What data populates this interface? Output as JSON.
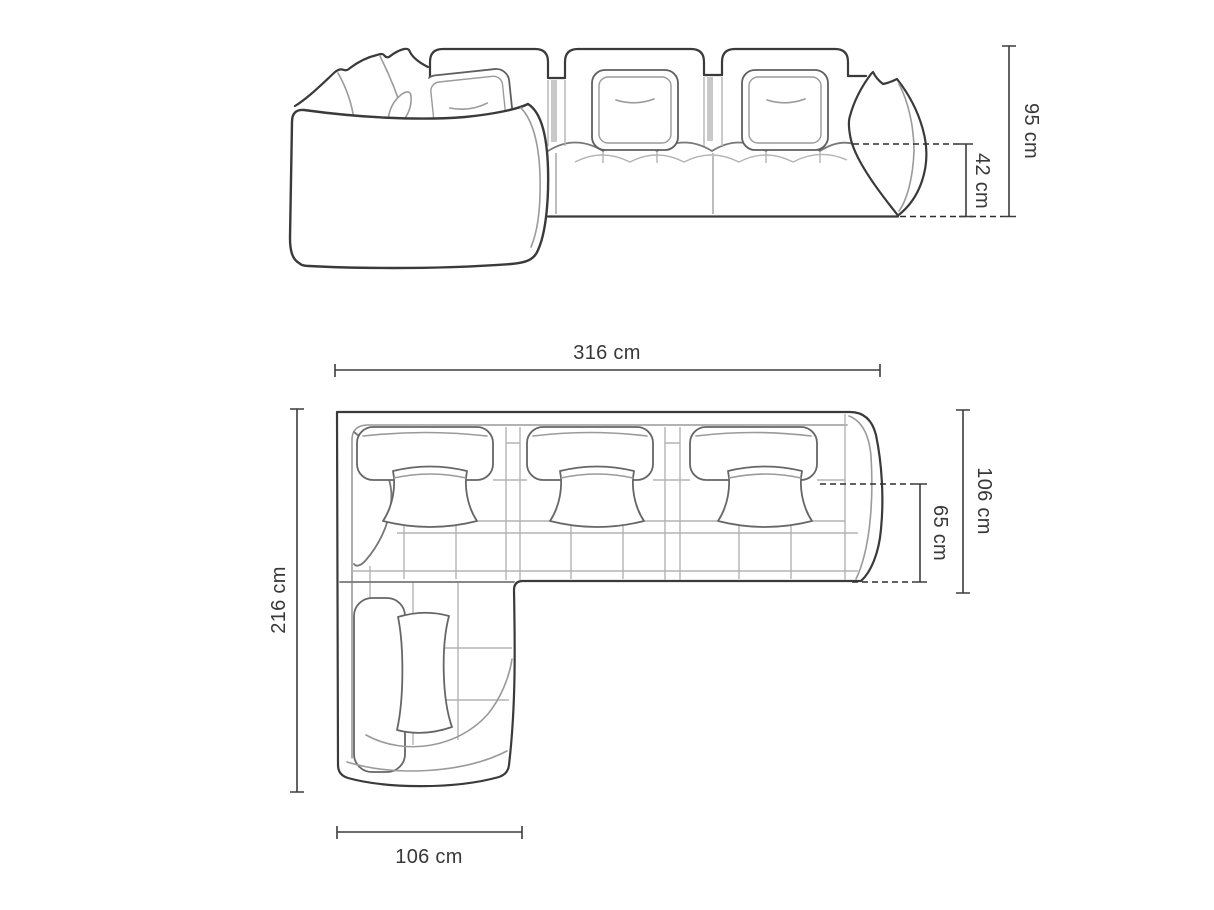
{
  "diagram": {
    "title": "corner-sofa-dimension-drawing",
    "background": "#ffffff",
    "outline_color": "#3a3a3a",
    "detail_color": "#8f8f8f",
    "dimension_color": "#3d3d3d",
    "unit": "cm",
    "views": {
      "front": {
        "name": "front-elevation",
        "dimensions": [
          {
            "id": "total-height",
            "label": "95 cm"
          },
          {
            "id": "seat-height",
            "label": "42 cm"
          }
        ]
      },
      "top": {
        "name": "top-plan",
        "dimensions": [
          {
            "id": "total-width",
            "label": "316 cm"
          },
          {
            "id": "total-depth",
            "label": "216 cm"
          },
          {
            "id": "right-side-depth",
            "label": "106 cm"
          },
          {
            "id": "seat-depth",
            "label": "65 cm"
          },
          {
            "id": "chaise-width",
            "label": "106 cm"
          }
        ]
      }
    }
  }
}
